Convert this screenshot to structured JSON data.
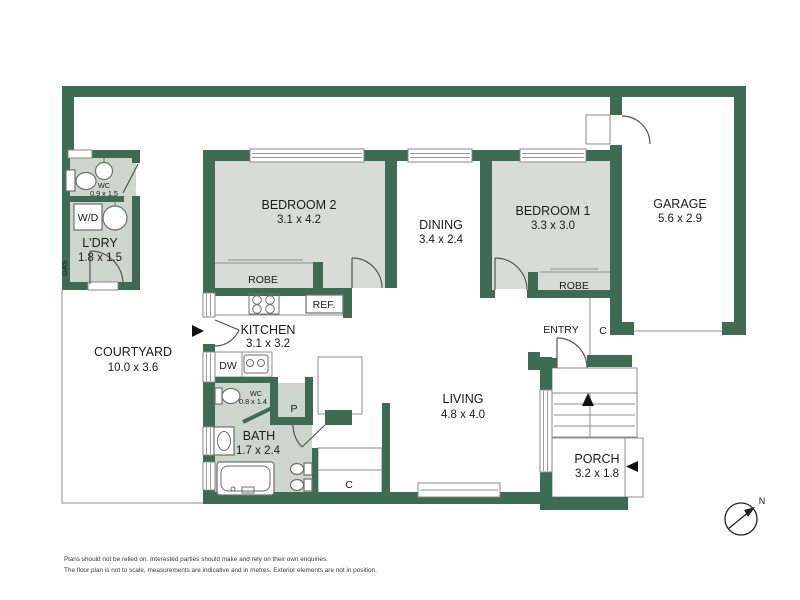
{
  "colors": {
    "wall_green": "#3e6b53",
    "bedroom_fill": "#d9dbd8",
    "wet_area_fill": "#ccd6cc",
    "outline_gray": "#8f8f8f",
    "text": "#1b1b1b"
  },
  "rooms": {
    "wc_upper": {
      "label": "WC",
      "dims": "0.9 x 1.5"
    },
    "laundry": {
      "label": "L'DRY",
      "dims": "1.8 x 1.5"
    },
    "gas": {
      "label": "GAS"
    },
    "washer": {
      "label": "W/D"
    },
    "bedroom2": {
      "label": "BEDROOM 2",
      "dims": "3.1 x 4.2"
    },
    "robe2": {
      "label": "ROBE"
    },
    "dining": {
      "label": "DINING",
      "dims": "3.4 x 2.4"
    },
    "bedroom1": {
      "label": "BEDROOM 1",
      "dims": "3.3 x 3.0"
    },
    "robe1": {
      "label": "ROBE"
    },
    "garage": {
      "label": "GARAGE",
      "dims": "5.6 x 2.9"
    },
    "kitchen": {
      "label": "KITCHEN",
      "dims": "3.1 x 3.2"
    },
    "fridge": {
      "label": "REF."
    },
    "dishwasher": {
      "label": "DW"
    },
    "courtyard": {
      "label": "COURTYARD",
      "dims": "10.0 x 3.6"
    },
    "wc_lower": {
      "label": "WC",
      "dims": "0.8 x 1.4"
    },
    "pantry": {
      "label": "P"
    },
    "bath": {
      "label": "BATH",
      "dims": "1.7 x 2.4"
    },
    "living": {
      "label": "LIVING",
      "dims": "4.8 x 4.0"
    },
    "entry": {
      "label": "ENTRY"
    },
    "cupboard_entry": {
      "label": "C"
    },
    "cupboard_bath": {
      "label": "C"
    },
    "porch": {
      "label": "PORCH",
      "dims": "3.2 x 1.8"
    }
  },
  "compass": {
    "label": "N"
  },
  "footer": {
    "line1": "Plans should not be relied on. Interested parties should make and rely on their own enquiries.",
    "line2": "The floor plan is not to scale, measurements are indicative and in metres. Exterior elements are not in position."
  }
}
